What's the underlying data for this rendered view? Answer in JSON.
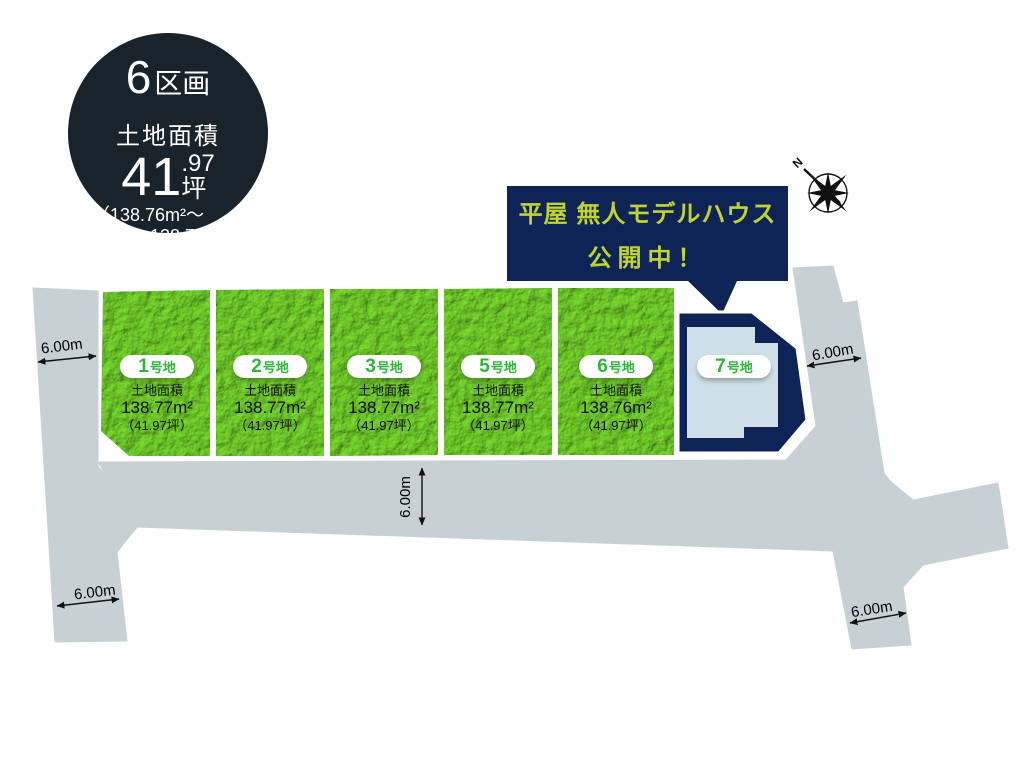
{
  "summary_badge": {
    "count": "6",
    "count_unit": "区画",
    "area_label": "土地面積",
    "tsubo_main": "41",
    "tsubo_dec": ".97",
    "tsubo_unit": "坪",
    "range_line1": "（138.76m²〜",
    "range_line2": "138.77m²）"
  },
  "callout": {
    "line1": "平屋 無人モデルハウス",
    "line2": "公開中！"
  },
  "compass": {
    "north_label": "N"
  },
  "plots": [
    {
      "number": "1",
      "suffix": "号地",
      "area_label": "土地面積",
      "area_m2": "138.77m²",
      "area_tsubo": "（41.97坪）"
    },
    {
      "number": "2",
      "suffix": "号地",
      "area_label": "土地面積",
      "area_m2": "138.77m²",
      "area_tsubo": "（41.97坪）"
    },
    {
      "number": "3",
      "suffix": "号地",
      "area_label": "土地面積",
      "area_m2": "138.77m²",
      "area_tsubo": "（41.97坪）"
    },
    {
      "number": "5",
      "suffix": "号地",
      "area_label": "土地面積",
      "area_m2": "138.77m²",
      "area_tsubo": "（41.97坪）"
    },
    {
      "number": "6",
      "suffix": "号地",
      "area_label": "土地面積",
      "area_m2": "138.76m²",
      "area_tsubo": "（41.97坪）"
    },
    {
      "number": "7",
      "suffix": "号地"
    }
  ],
  "dimensions": [
    {
      "text": "6.00m",
      "location": "west-road"
    },
    {
      "text": "6.00m",
      "location": "east-road"
    },
    {
      "text": "6.00m",
      "location": "south-road-center"
    },
    {
      "text": "6.00m",
      "location": "southwest-road"
    },
    {
      "text": "6.00m",
      "location": "southeast-road"
    }
  ],
  "colors": {
    "summary_badge_bg": "#18232c",
    "callout_bg": "#0f2456",
    "callout_text": "#c1d32e",
    "plot_green": "#7fd438",
    "plot_number_green": "#2fb43a",
    "road_gray": "#c6d0d5",
    "model_plot_navy": "#0f2456",
    "house_footprint": "#cfdfe9"
  }
}
